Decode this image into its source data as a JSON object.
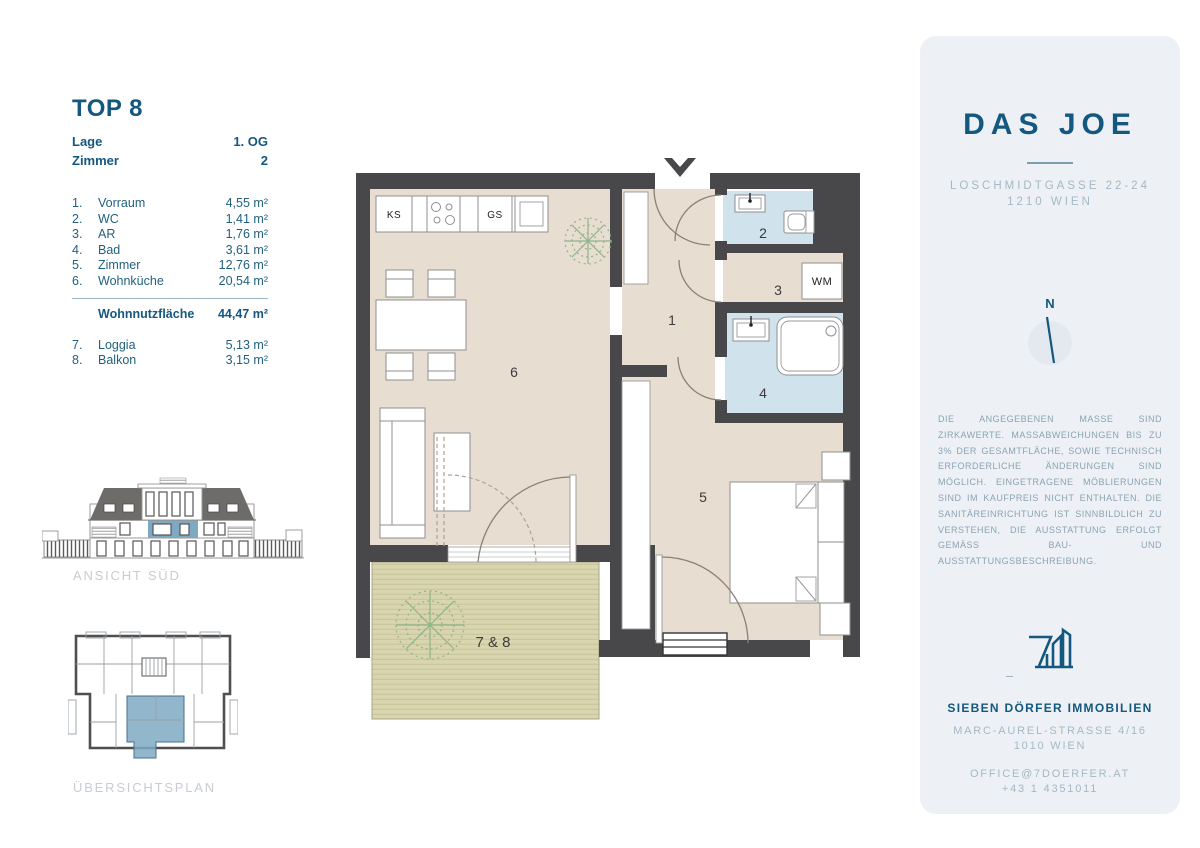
{
  "unit": {
    "title": "TOP 8",
    "meta": [
      {
        "label": "Lage",
        "value": "1. OG"
      },
      {
        "label": "Zimmer",
        "value": "2"
      }
    ],
    "rooms": [
      {
        "no": "1.",
        "name": "Vorraum",
        "area": "4,55 m²"
      },
      {
        "no": "2.",
        "name": "WC",
        "area": "1,41 m²"
      },
      {
        "no": "3.",
        "name": "AR",
        "area": "1,76 m²"
      },
      {
        "no": "4.",
        "name": "Bad",
        "area": "3,61 m²"
      },
      {
        "no": "5.",
        "name": "Zimmer",
        "area": "12,76 m²"
      },
      {
        "no": "6.",
        "name": "Wohnküche",
        "area": "20,54 m²"
      }
    ],
    "total": {
      "label": "Wohnnutzfläche",
      "value": "44,47 m²"
    },
    "outdoor": [
      {
        "no": "7.",
        "name": "Loggia",
        "area": "5,13 m²"
      },
      {
        "no": "8.",
        "name": "Balkon",
        "area": "3,15 m²"
      }
    ]
  },
  "drawings": {
    "elevation_label": "ANSICHT SÜD",
    "overview_label": "ÜBERSICHTSPLAN"
  },
  "floorplan": {
    "labels": {
      "r1": "1",
      "r2": "2",
      "r3": "3",
      "r4": "4",
      "r5": "5",
      "r6": "6",
      "terrace": "7 & 8"
    },
    "fixtures": {
      "ks": "KS",
      "gs": "GS",
      "wm": "WM"
    }
  },
  "panel": {
    "project": "DAS JOE",
    "address_line1": "LOSCHMIDTGASSE 22-24",
    "address_line2": "1210 WIEN",
    "compass_north": "N",
    "disclaimer": "DIE ANGEGEBENEN MASSE SIND ZIRKAWERTE. MASSABWEICHUNGEN BIS ZU 3% DER GESAMTFLÄCHE, SOWIE TECHNISCH ERFORDERLICHE ÄNDERUNGEN SIND MÖGLICH. EINGETRAGENE MÖBLIERUNGEN SIND IM KAUFPREIS NICHT ENTHALTEN. DIE SANITÄREINRICHTUNG IST SINNBILDLICH ZU VERSTEHEN, DIE AUSSTATTUNG ERFOLGT GEMÄSS BAU- UND AUSSTATTUNGSBESCHREIBUNG.",
    "company": "SIEBEN DÖRFER IMMOBILIEN",
    "company_address1": "MARC-AUREL-STRASSE 4/16",
    "company_address2": "1010 WIEN",
    "email": "OFFICE@7DOERFER.AT",
    "phone": "+43 1 4351011"
  },
  "colors": {
    "accent": "#14577f",
    "muted": "#a5b8c4",
    "panel_bg": "#edf1f5",
    "wall": "#48484a",
    "floor": "#e8ddd1",
    "bath": "#d0e2ec",
    "terrace": "#d9d5ae",
    "terrace_line": "#c6c29b",
    "highlight": "#7fa9c2",
    "plant": "#8fb48a",
    "label_gray": "#c7cdd3",
    "list_text": "#21617f"
  }
}
